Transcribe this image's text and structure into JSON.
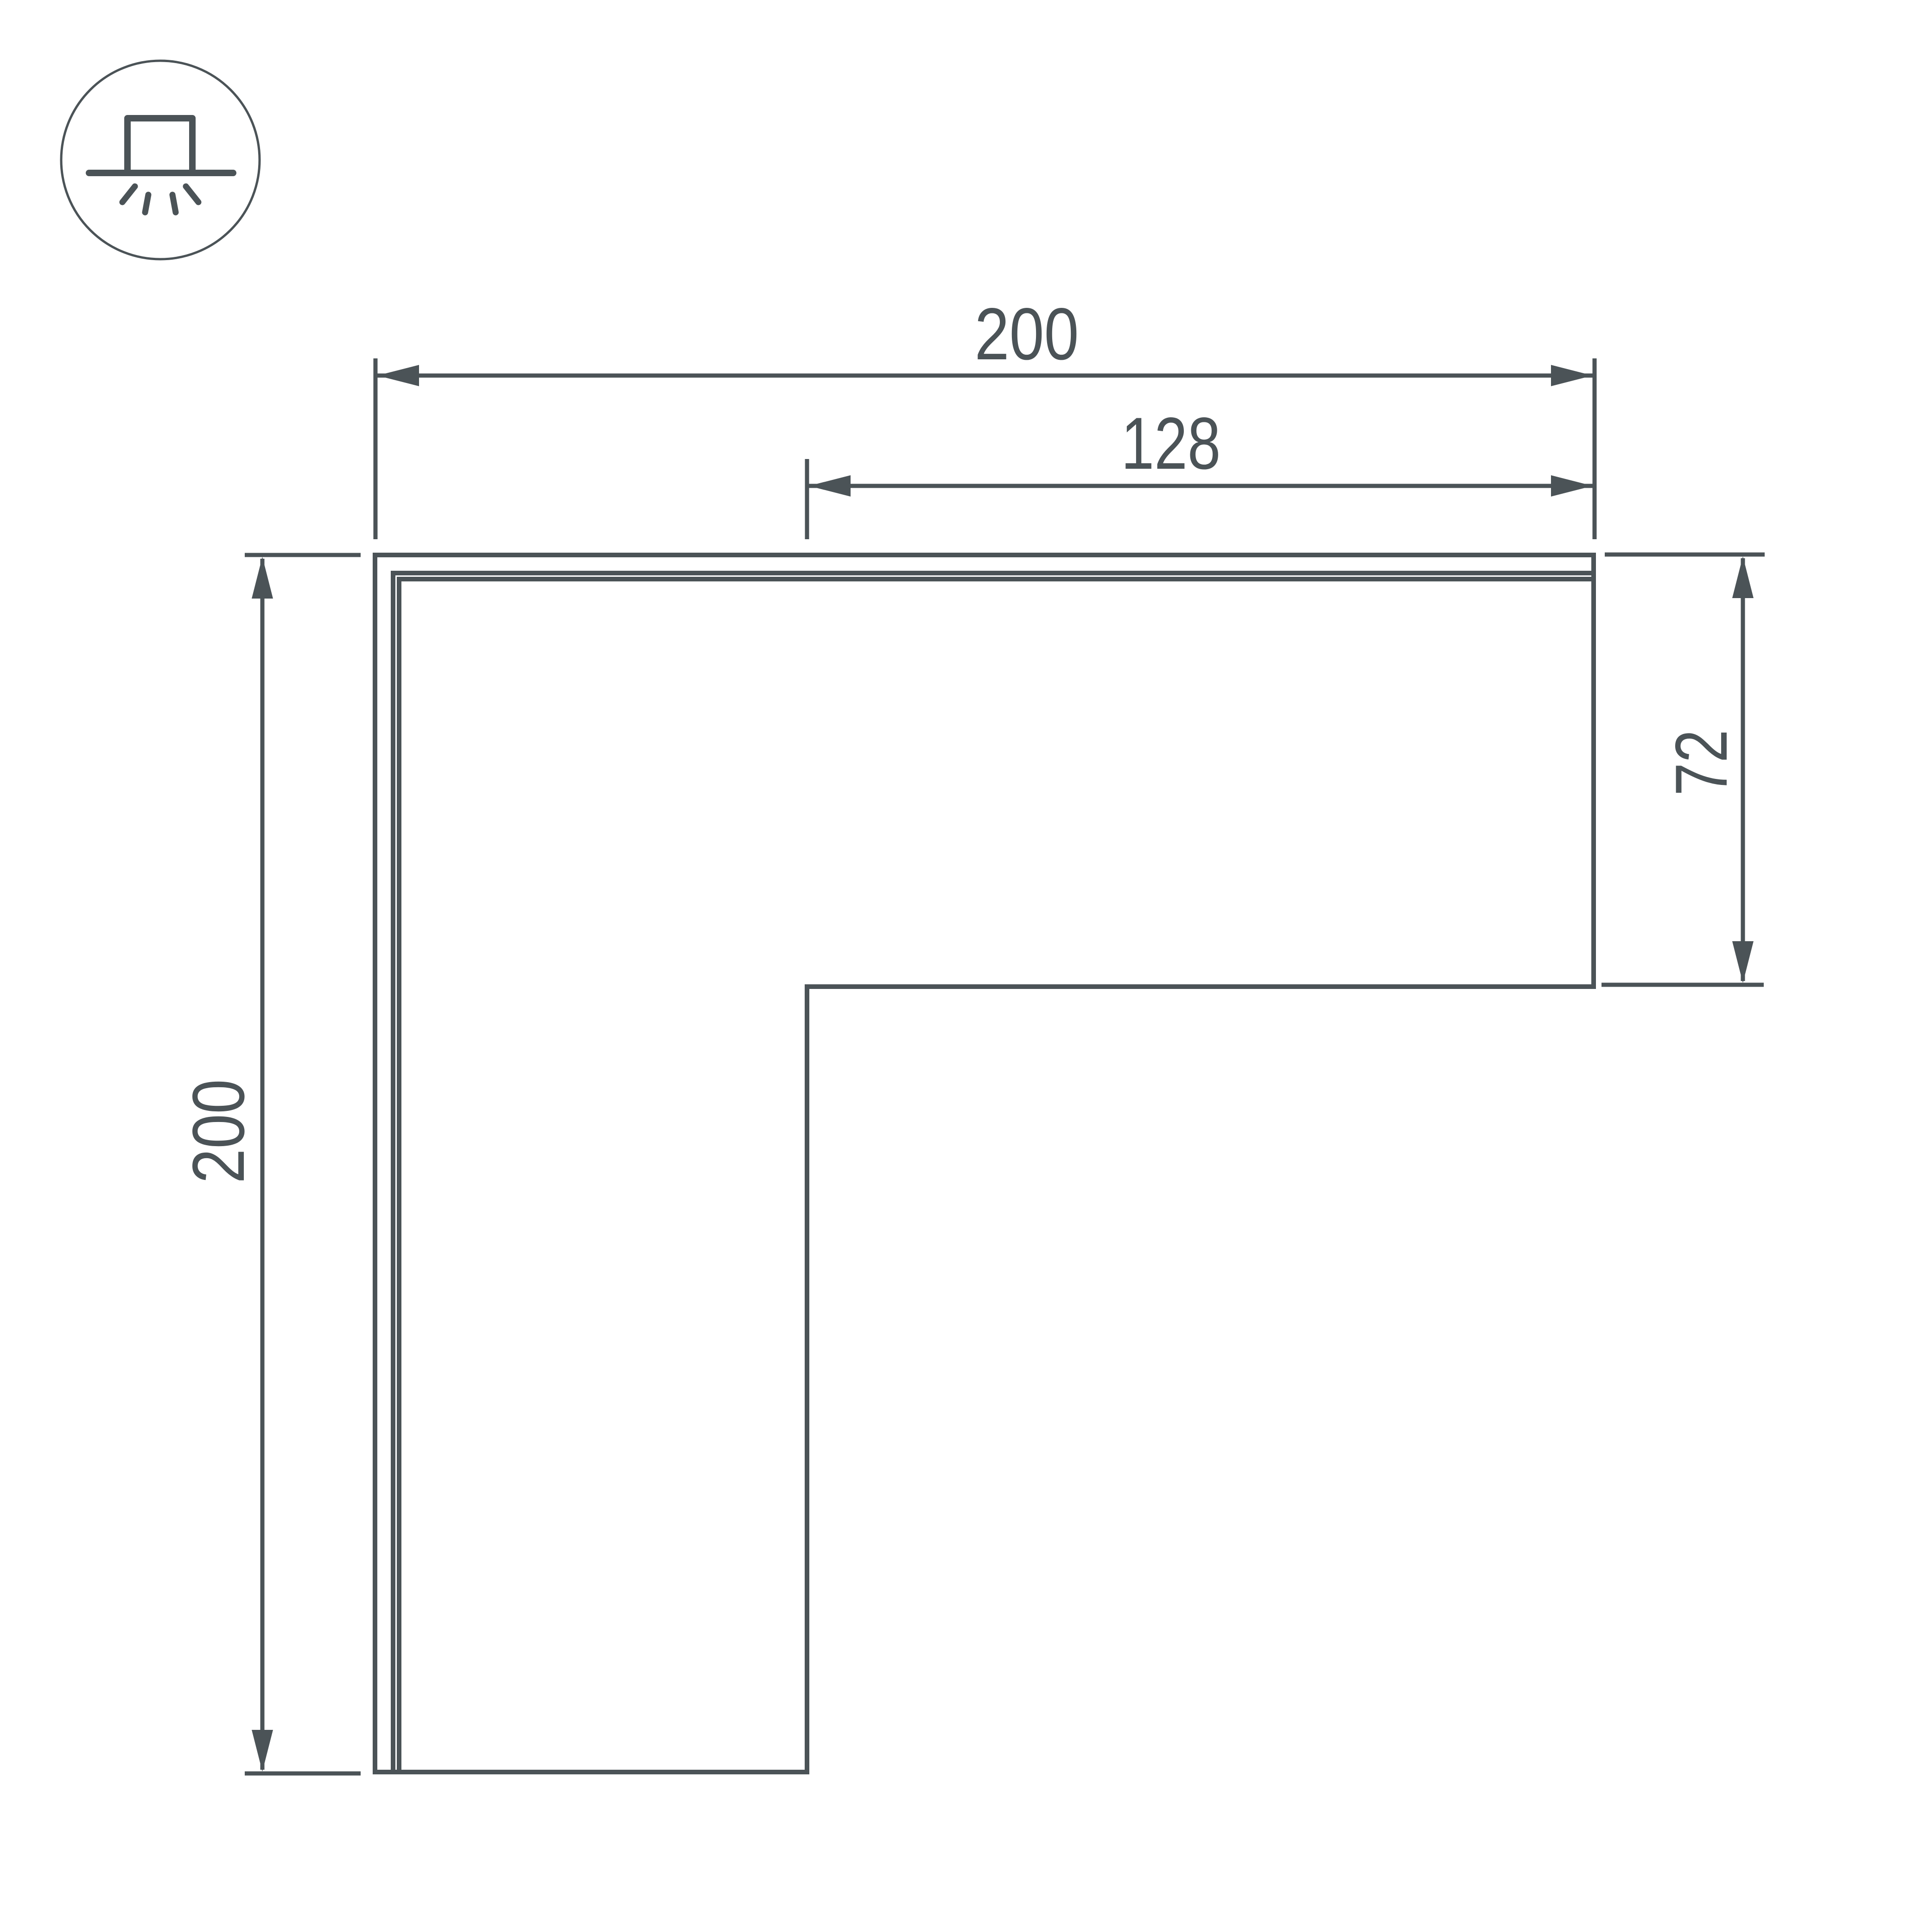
{
  "colors": {
    "line": "#4B5357",
    "background": "#FFFFFF"
  },
  "icons": {
    "mounting_type": "surface-mount-light-icon"
  },
  "dimensions": {
    "top_width": "200",
    "top_inner_width": "128",
    "left_height": "200",
    "right_step_height": "72"
  }
}
